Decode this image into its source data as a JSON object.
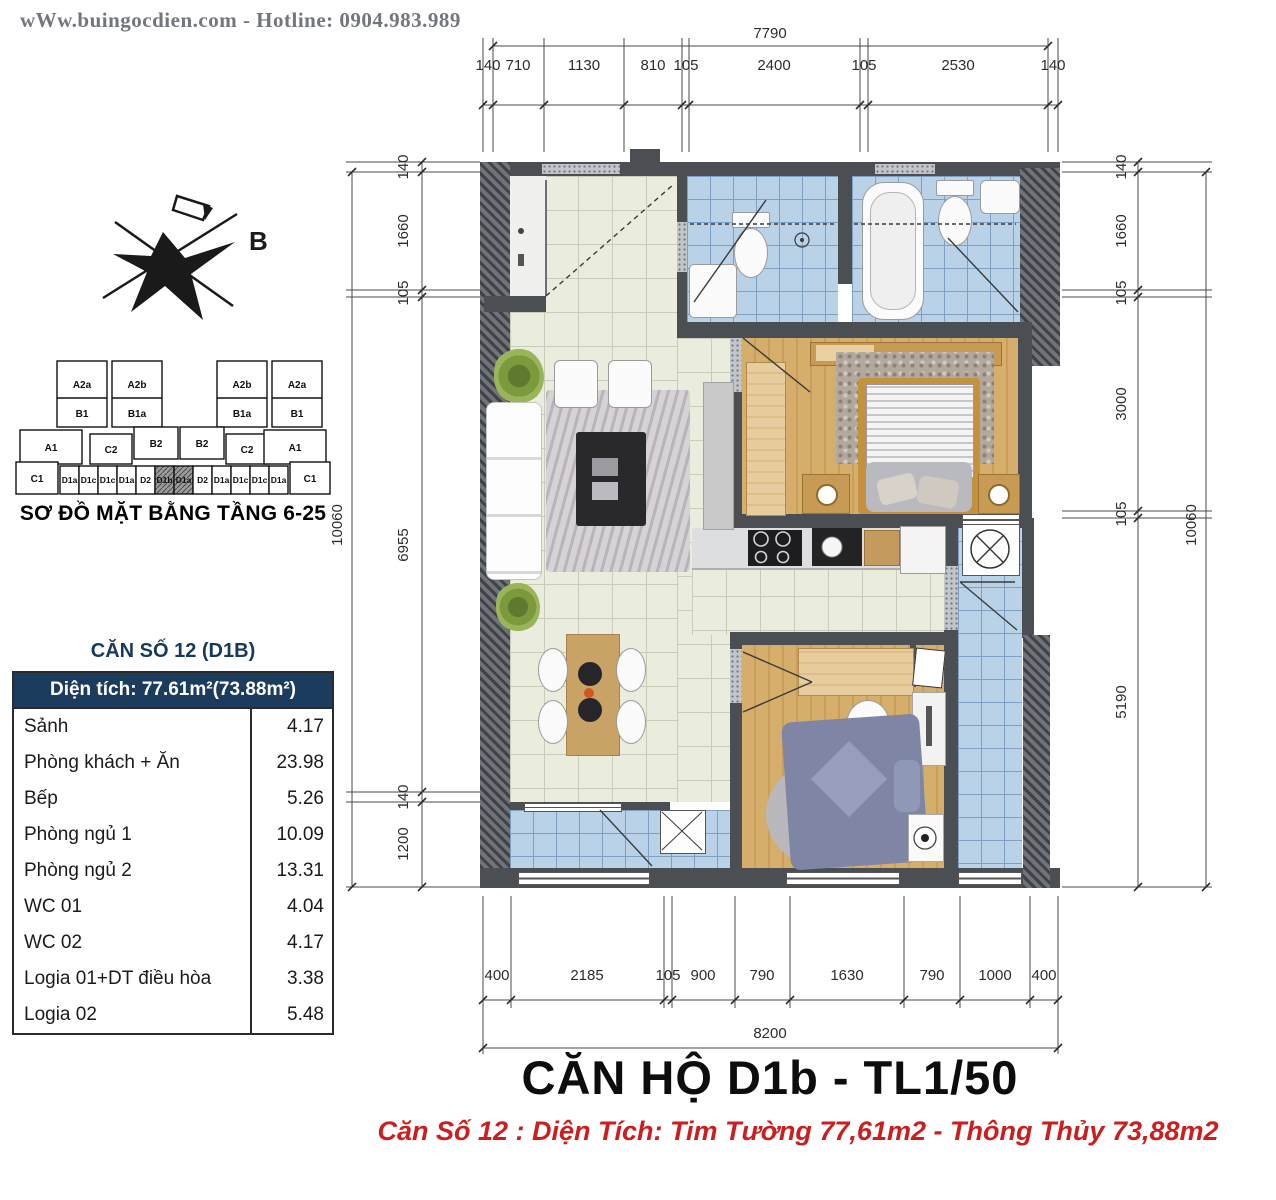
{
  "header": {
    "text": "wWw.buingocdien.com  -  Hotline: 0904.983.989"
  },
  "compass": {
    "label": "B"
  },
  "keyplan": {
    "title": "SƠ ĐỒ MẶT BẰNG TẦNG 6-25",
    "towers": [
      {
        "top": "A2a",
        "bottom": "B1"
      },
      {
        "top": "A2b",
        "bottom": "B1a"
      },
      {
        "top": "A2b",
        "bottom": "B1a"
      },
      {
        "top": "A2a",
        "bottom": "B1"
      }
    ],
    "mid_blocks": [
      "A1",
      "C2",
      "B2",
      "B2",
      "C2",
      "A1"
    ],
    "bottom_units": [
      "C1",
      "D1a",
      "D1c",
      "D1c",
      "D1a",
      "D2",
      "D1b",
      "D1a",
      "D2",
      "D1a",
      "D1c",
      "D1c",
      "D1a",
      "C1"
    ],
    "highlighted_units": [
      "D1b",
      "D1a"
    ]
  },
  "area_table": {
    "title": "CĂN SỐ 12 (D1B)",
    "header": "Diện tích: 77.61m²(73.88m²)",
    "rows": [
      {
        "label": "Sảnh",
        "value": "4.17"
      },
      {
        "label": "Phòng khách + Ăn",
        "value": "23.98"
      },
      {
        "label": "Bếp",
        "value": "5.26"
      },
      {
        "label": "Phòng ngủ 1",
        "value": "10.09"
      },
      {
        "label": "Phòng ngủ 2",
        "value": "13.31"
      },
      {
        "label": "WC 01",
        "value": "4.04"
      },
      {
        "label": "WC 02",
        "value": "4.17"
      },
      {
        "label": "Logia 01+DT điều hòa",
        "value": "3.38"
      },
      {
        "label": "Logia 02",
        "value": "5.48"
      }
    ]
  },
  "dimensions": {
    "top": {
      "overall": "7790",
      "segments": [
        "140",
        "710",
        "1130",
        "810",
        "105",
        "2400",
        "105",
        "2530",
        "140"
      ]
    },
    "bottom": {
      "overall": "8200",
      "segments": [
        "400",
        "2185",
        "105",
        "900",
        "790",
        "1630",
        "790",
        "1000",
        "400"
      ]
    },
    "left": {
      "overall": "10060",
      "segments": [
        "140",
        "1660",
        "105",
        "6955",
        "140",
        "1200"
      ]
    },
    "right": {
      "overall": "10060",
      "segments": [
        "140",
        "1660",
        "105",
        "3000",
        "105",
        "5190"
      ]
    }
  },
  "footer": {
    "title": "CĂN HỘ D1b - TL1/50",
    "subtitle": "Căn Số 12 : Diện Tích: Tim Tường 77,61m2 - Thông Thủy 73,88m2"
  },
  "colors": {
    "navy": "#1c3c5e",
    "red": "#cb1f1f",
    "wall": "#4b4e53",
    "tile": "#eaecdd",
    "blue_tile": "#b9d2e8",
    "wood": "#d0a763"
  }
}
